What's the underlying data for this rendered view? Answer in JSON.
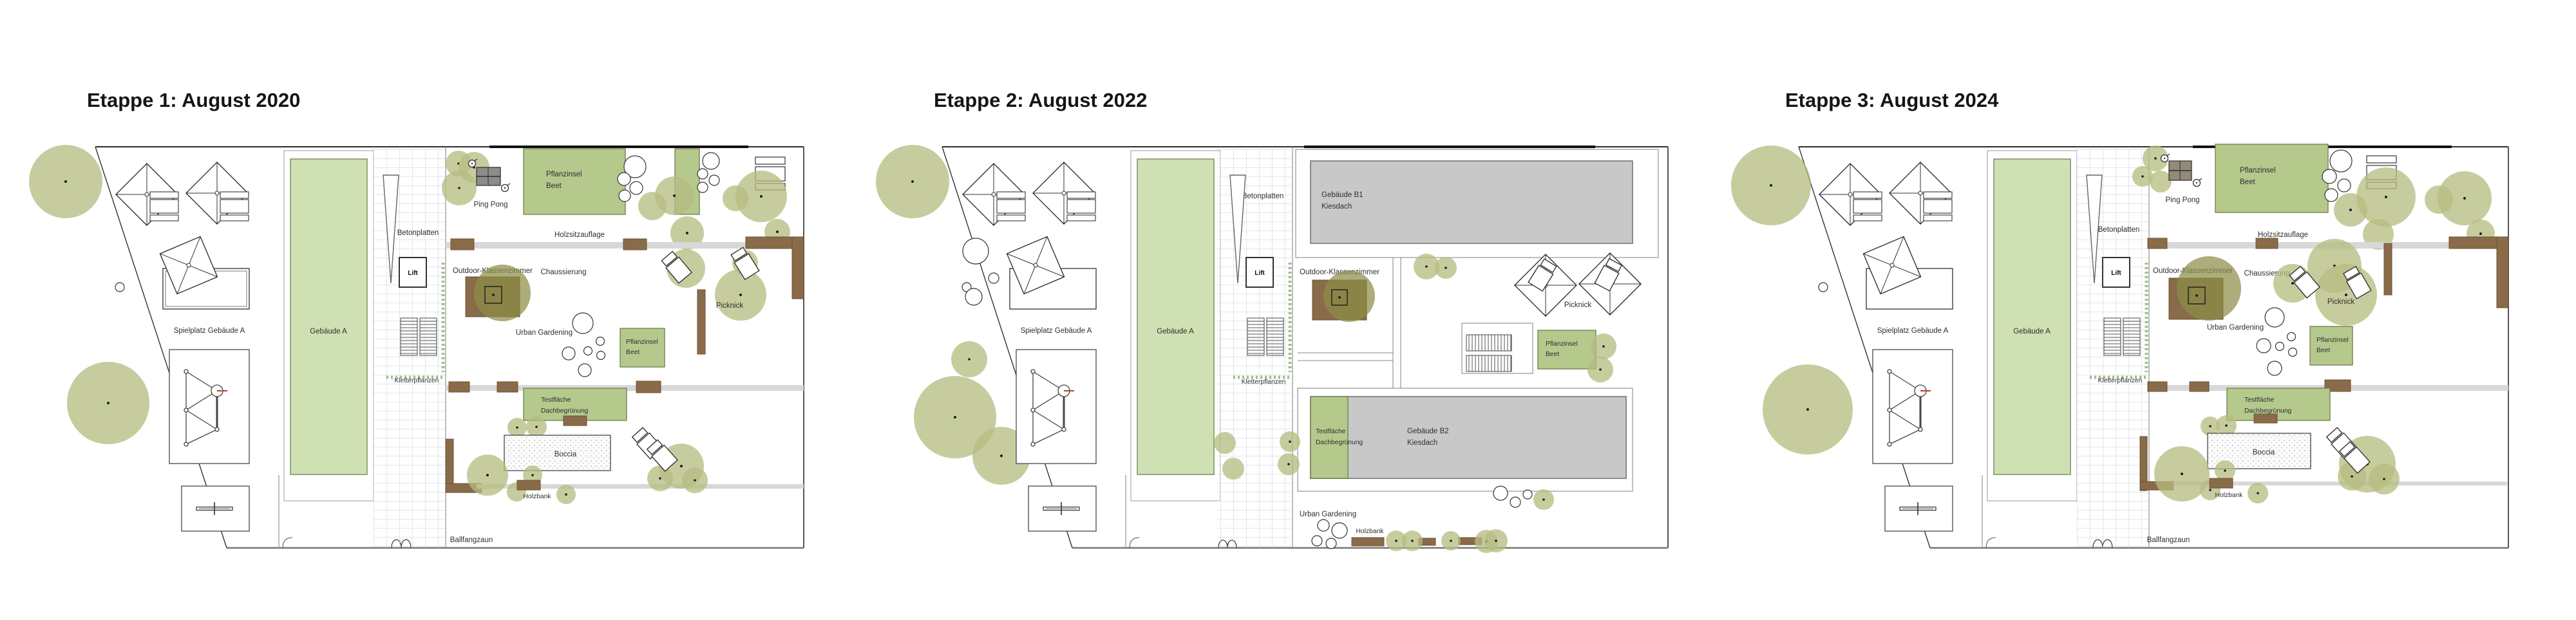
{
  "colors": {
    "tree": "#b6bc7f",
    "planting-green": "#b5c98d",
    "building-green": "#cfe1b2",
    "temp-gray": "#c8c8c8",
    "wood": "#8a6b49",
    "wood-dark": "#6b5233",
    "path": "#d8d8d8",
    "vegetation": "#76a356"
  },
  "panels": [
    {
      "title": "Etappe 1: August 2020",
      "labels": {
        "spielplatz": "Spielplatz Gebäude A",
        "gebaeude_a": "Gebäude A",
        "betonplatten": "Betonplatten",
        "lift": "Lift",
        "kletterpflanzen": "Kletterpflanzen",
        "ping_pong": "Ping Pong",
        "pflanzinsel": "Pflanzinsel",
        "beet": "Beet",
        "holzsitzauflage": "Holzsitzauflage",
        "outdoor_klassenzimmer": "Outdoor-Klassenzimmer",
        "chaussierung": "Chaussierung",
        "urban_gardening": "Urban Gardening",
        "picknick": "Picknick",
        "testflaeche": "Testfläche",
        "dachbegruenung": "Dachbegrünung",
        "boccia": "Boccia",
        "holzbank": "Holzbank",
        "ballfangzaun": "Ballfangzaun"
      }
    },
    {
      "title": "Etappe 2: August 2022",
      "labels": {
        "spielplatz": "Spielplatz Gebäude A",
        "gebaeude_a": "Gebäude A",
        "betonplatten": "Betonplatten",
        "lift": "Lift",
        "kletterpflanzen": "Kletterpflanzen",
        "gebaeude_b1": "Gebäude B1",
        "kiesdach": "Kiesdach",
        "outdoor_klassenzimmer": "Outdoor-Klassenzimmer",
        "picknick": "Picknick",
        "pflanzinsel": "Pflanzinsel",
        "beet": "Beet",
        "testflaeche": "Testfläche",
        "dachbegruenung": "Dachbegrünung",
        "gebaeude_b2": "Gebäude B2",
        "urban_gardening": "Urban Gardening",
        "holzbank": "Holzbank"
      }
    },
    {
      "title": "Etappe 3: August 2024",
      "labels": {
        "spielplatz": "Spielplatz Gebäude A",
        "gebaeude_a": "Gebäude A",
        "betonplatten": "Betonplatten",
        "lift": "Lift",
        "kletterpflanzen": "Kletterpflanzen",
        "ping_pong": "Ping Pong",
        "pflanzinsel": "Pflanzinsel",
        "beet": "Beet",
        "holzsitzauflage": "Holzsitzauflage",
        "outdoor_klassenzimmer": "Outdoor-Klassenzimmer",
        "chaussierung": "Chaussierung",
        "urban_gardening": "Urban Gardening",
        "picknick": "Picknick",
        "testflaeche": "Testfläche",
        "dachbegruenung": "Dachbegrünung",
        "boccia": "Boccia",
        "holzbank": "Holzbank",
        "ballfangzaun": "Ballfangzaun"
      }
    }
  ]
}
